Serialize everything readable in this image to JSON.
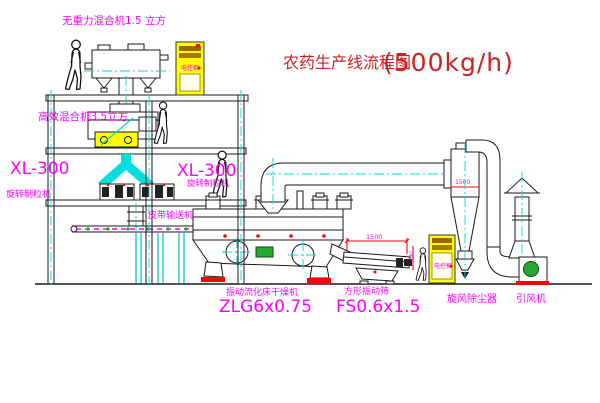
{
  "title": {
    "text": "农药生产线流程图",
    "capacity": "(500kg/h)"
  },
  "labels": {
    "top_mixer": "无重力混合机1.5 立方",
    "mid_mixer": "高效混合机3.5立方",
    "granulator_left": {
      "model": "XL-300",
      "name": "旋转制粒机"
    },
    "granulator_right": {
      "model": "XL-300",
      "name": "旋转制粒机"
    },
    "belt_conveyor": "皮带输送机",
    "dryer": {
      "name": "振动流化床干燥机",
      "model": "ZLG6x0.75"
    },
    "sieve": {
      "name": "方形振动筛",
      "model": "FS0.6x1.5"
    },
    "cyclone": "旋风除尘器",
    "fan": "引风机",
    "control_cabinet": "电控柜"
  },
  "dimensions": {
    "sieve_length": "1500",
    "sieve_height": "740",
    "cyclone": "1500"
  },
  "colors": {
    "label_magenta": "#ff00ff",
    "title_red": "#cc2222",
    "centerline_cyan": "#00d8d8",
    "dimension_red": "#ff0000",
    "cabinet_yellow": "#ffff00",
    "motor_green": "#22aa33"
  }
}
